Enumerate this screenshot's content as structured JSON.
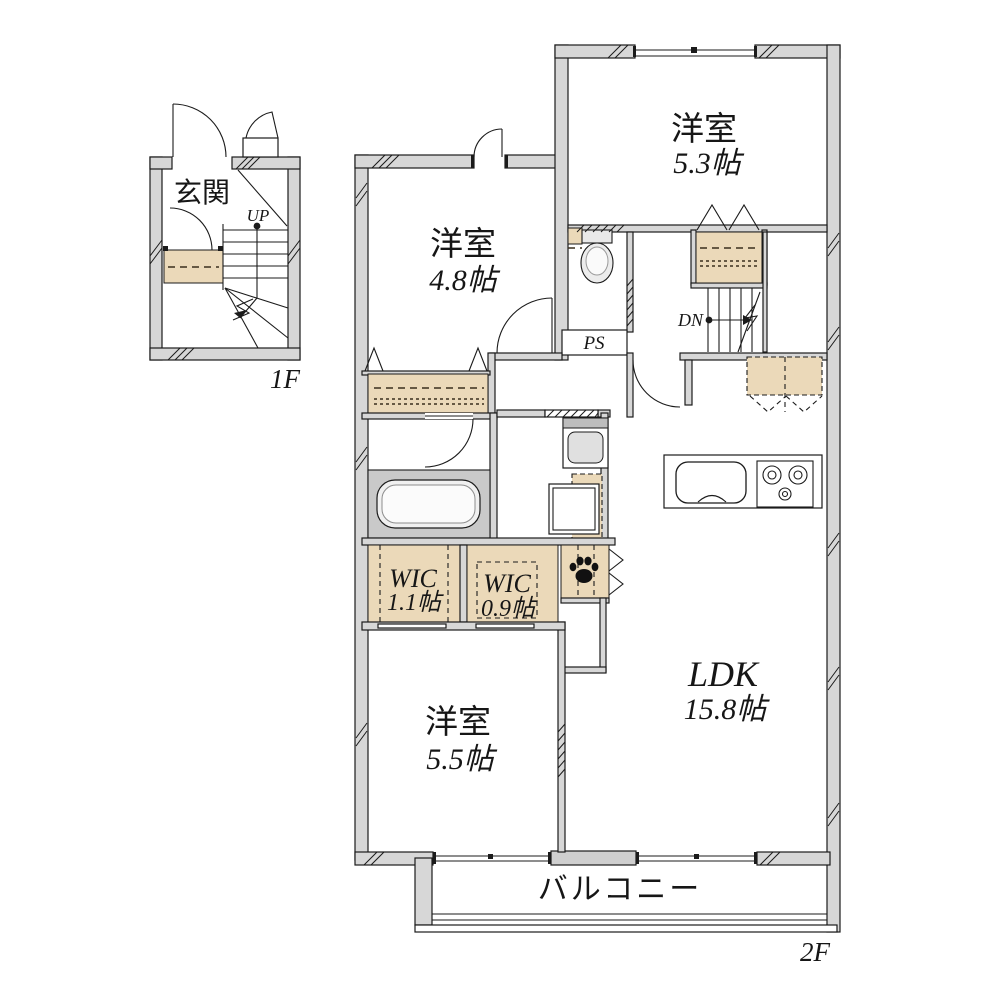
{
  "title": "2-story apartment floor plan",
  "colors": {
    "background": "#ffffff",
    "wall_fill": "#d7d7d7",
    "closet_fill": "#ebd9b9",
    "bath_zone_fill": "#c9c9c9",
    "line": "#1b1b1b"
  },
  "floor_1f": {
    "label": "1F",
    "rooms": {
      "entrance": {
        "name": "玄関"
      }
    },
    "stairs": {
      "direction_label": "UP"
    }
  },
  "floor_2f": {
    "label": "2F",
    "rooms": {
      "bedroom_top": {
        "name": "洋室",
        "size": "5.3帖"
      },
      "bedroom_mid": {
        "name": "洋室",
        "size": "4.8帖"
      },
      "bedroom_bottom": {
        "name": "洋室",
        "size": "5.5帖"
      },
      "ldk": {
        "name": "LDK",
        "size": "15.8帖"
      },
      "wic_large": {
        "name": "WIC",
        "size": "1.1帖"
      },
      "wic_small": {
        "name": "WIC",
        "size": "0.9帖"
      },
      "pipe_space": {
        "name": "PS"
      },
      "balcony": {
        "name": "バルコニー"
      }
    },
    "stairs": {
      "direction_label": "DN"
    }
  }
}
